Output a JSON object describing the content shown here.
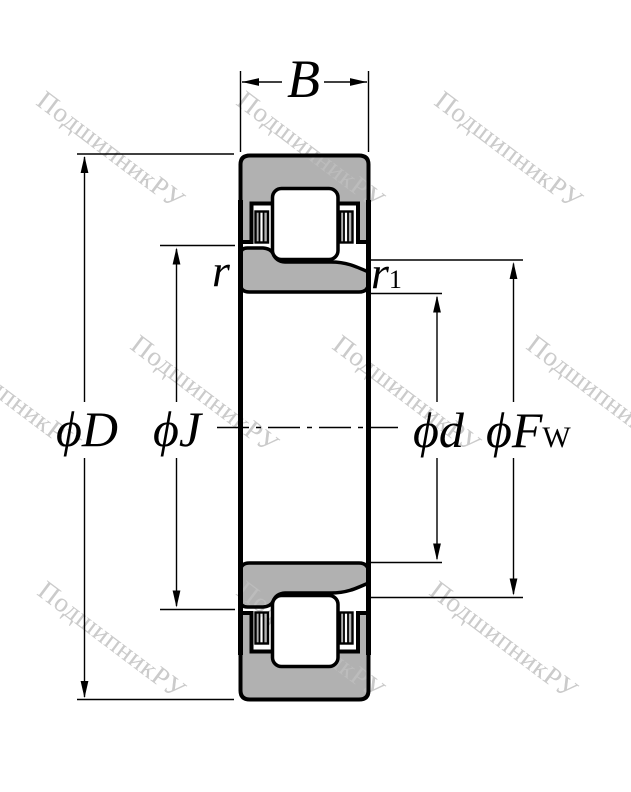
{
  "diagram": {
    "kind": "bearing cross-section engineering drawing"
  },
  "dimensions": {
    "width_label": "B",
    "outer_diameter_label": "ϕD",
    "flange_diameter_label": "ϕJ",
    "bore_diameter_label": "ϕd",
    "raceway_diameter_label": "ϕF",
    "raceway_diameter_subscript": "W",
    "outer_ring_chamfer_label": "r",
    "inner_ring_chamfer_label": "r",
    "inner_ring_chamfer_subscript": "1"
  },
  "watermark": {
    "text": "ПодшипникРУ",
    "color": "#c8c8c8"
  },
  "colors": {
    "ring_fill": "#b1b1b1",
    "outline": "#000000",
    "background": "#ffffff",
    "dimension_lines": "#000000"
  }
}
